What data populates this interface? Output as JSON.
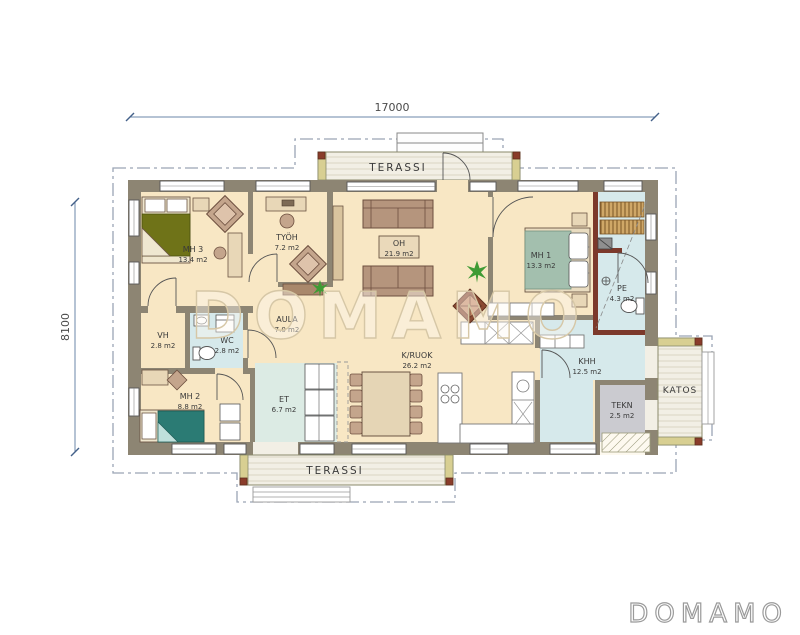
{
  "watermark": "DOMAMO",
  "logo": "DOMAMO",
  "dimensions": {
    "width_label": "17000",
    "height_label": "8100"
  },
  "rooms": {
    "mh3": {
      "label": "MH 3",
      "area": "13.4 m2"
    },
    "tyoh": {
      "label": "TYÖH",
      "area": "7.2 m2"
    },
    "oh": {
      "label": "OH",
      "area": "21.9 m2"
    },
    "mh1": {
      "label": "MH 1",
      "area": "13.3 m2"
    },
    "pe": {
      "label": "PE",
      "area": "4.3 m2"
    },
    "vh": {
      "label": "VH",
      "area": "2.8 m2"
    },
    "wc": {
      "label": "WC",
      "area": "2.8 m2"
    },
    "aula": {
      "label": "AULA",
      "area": "7.0 m2"
    },
    "mh2": {
      "label": "MH 2",
      "area": "8.8 m2"
    },
    "et": {
      "label": "ET",
      "area": "6.7 m2"
    },
    "kruok": {
      "label": "K/RUOK",
      "area": "26.2 m2"
    },
    "khh": {
      "label": "KHH",
      "area": "12.5 m2"
    },
    "tekn": {
      "label": "TEKN",
      "area": "2.5 m2"
    }
  },
  "outdoor": {
    "terassi_top": "TERASSI",
    "terassi_bottom": "TERASSI",
    "katos": "KATOS"
  },
  "colors": {
    "wall": "#8d8573",
    "floor_cream": "#f8e7c4",
    "floor_wet_blue": "#d6e9eb",
    "floor_entry": "#dcebe4",
    "floor_tech": "#cbcbd0",
    "sauna_wall_rust": "#7c392b",
    "bed_olive": "#6f7318",
    "bed_teal": "#2b7b74",
    "bed_sage": "#a3bfae",
    "sofa_brown": "#b5957d",
    "furniture_tan": "#e8d7b7",
    "deck_wood": "#f2efe5",
    "deck_edge": "#d8cf92",
    "plant_green": "#3f9b35",
    "roof_line": "#9aa5b5",
    "dimension_line": "#6b87a8"
  }
}
